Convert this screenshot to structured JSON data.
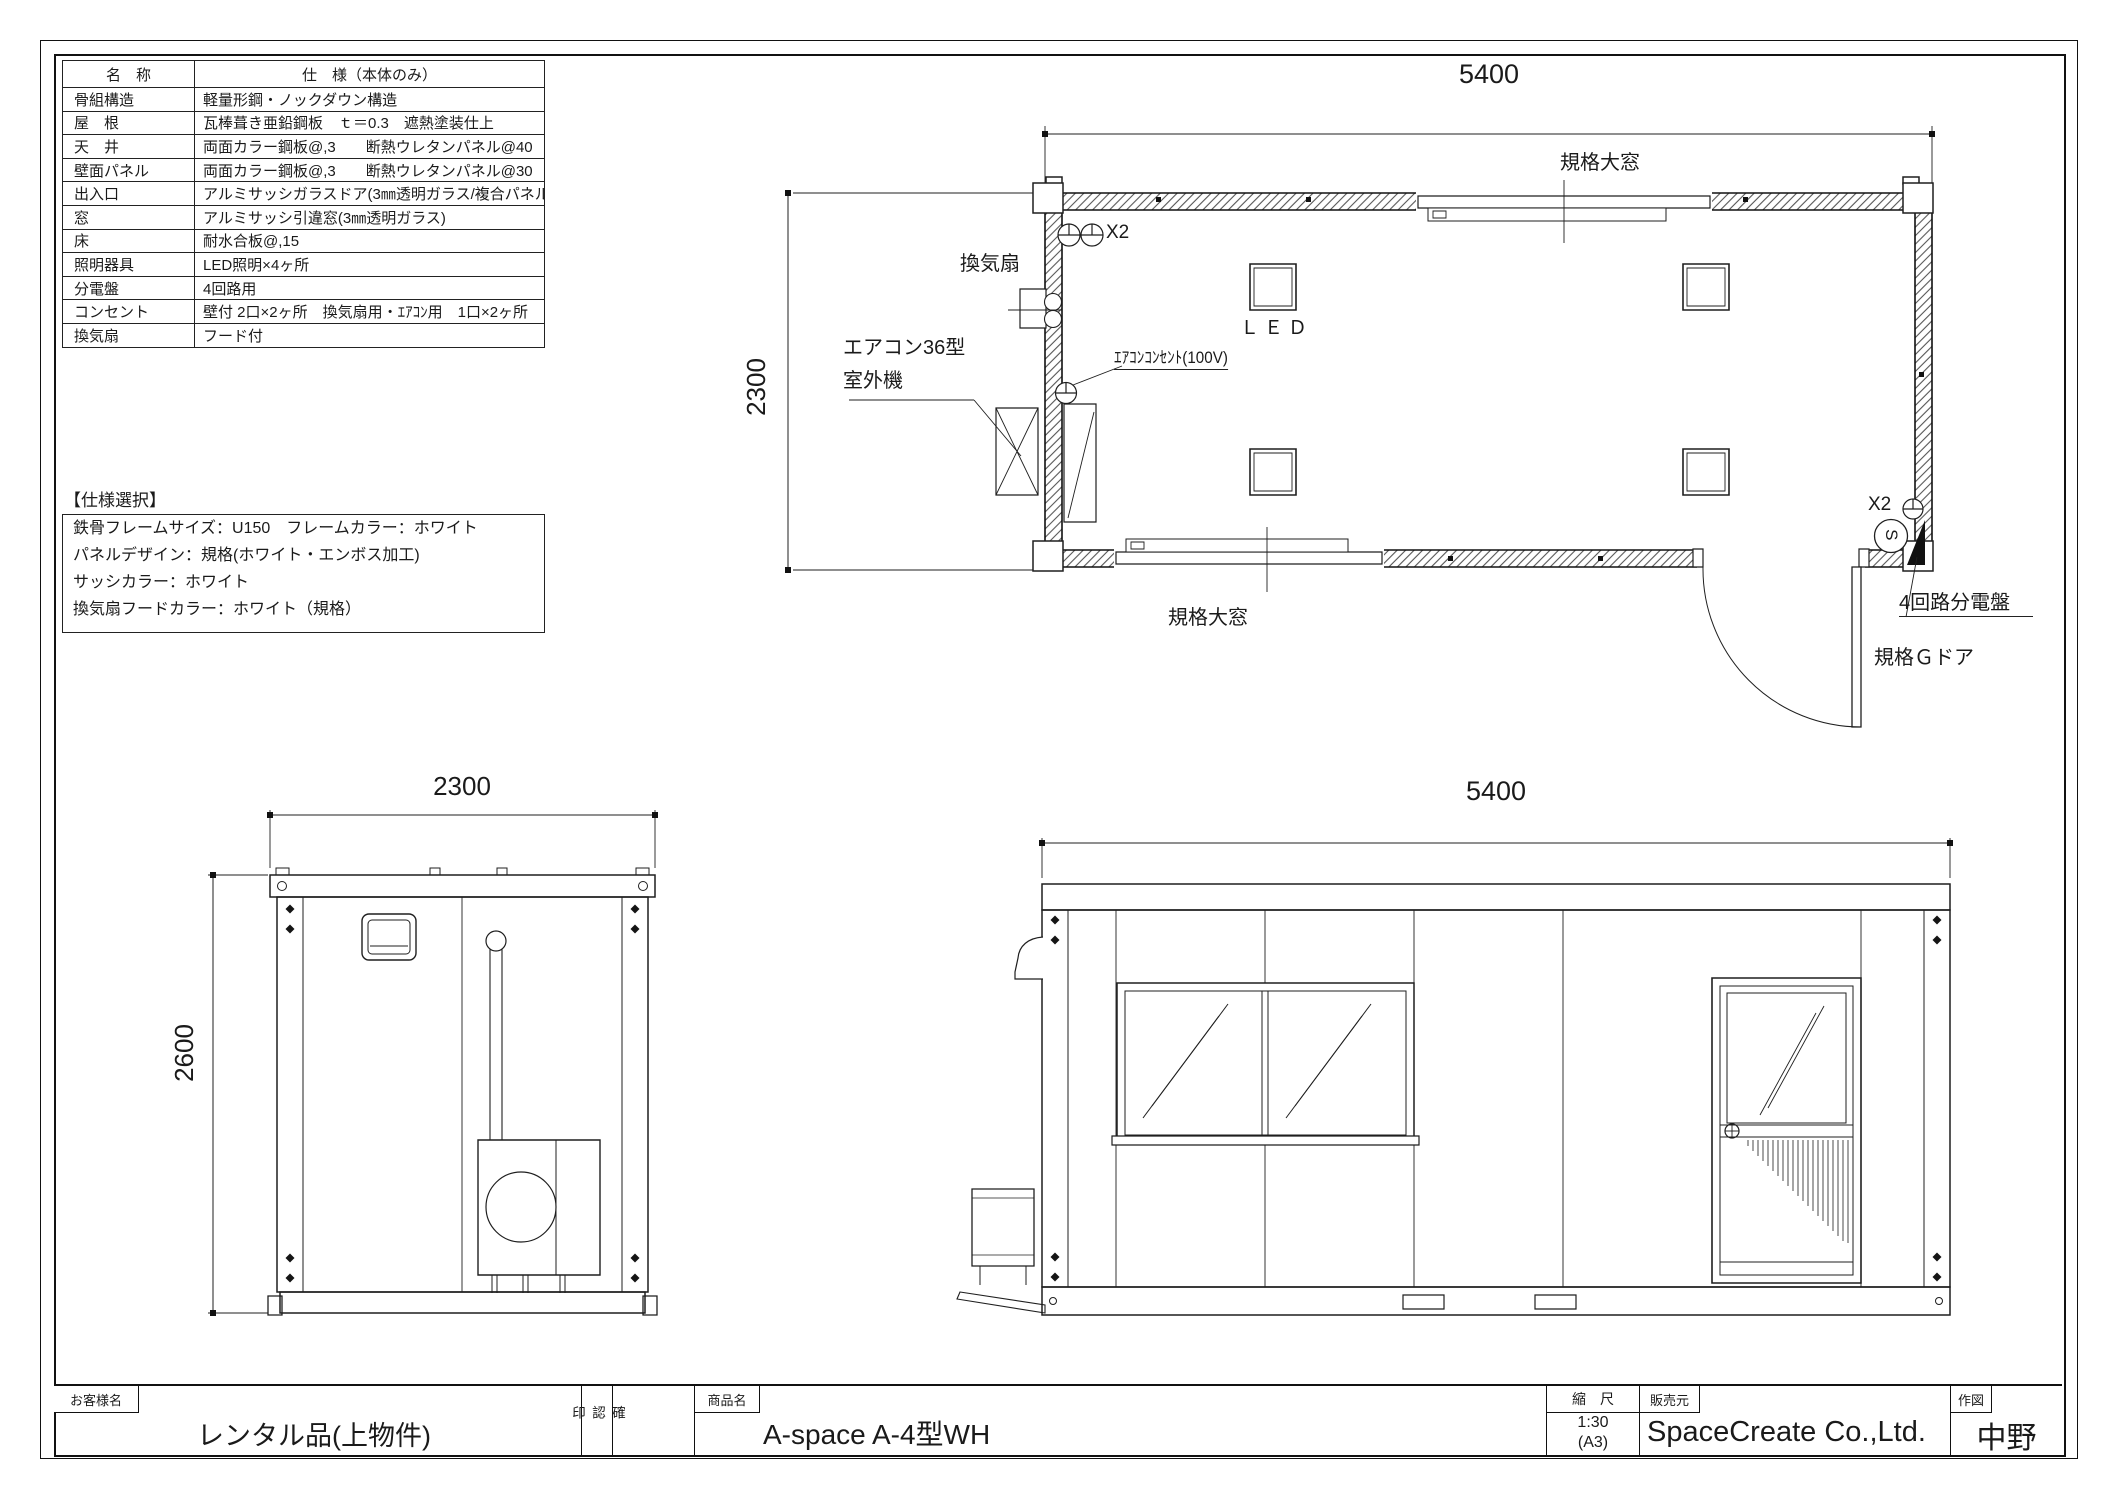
{
  "spec_table": {
    "header": {
      "name": "名　称",
      "spec": "仕　様（本体のみ）"
    },
    "rows": [
      {
        "name": "骨組構造",
        "value": "軽量形鋼・ノックダウン構造"
      },
      {
        "name": "屋　根",
        "value": "瓦棒葺き亜鉛鋼板　ｔ＝0.3　遮熱塗装仕上"
      },
      {
        "name": "天　井",
        "value": "両面カラー鋼板@,3　　断熱ウレタンパネル@40"
      },
      {
        "name": "壁面パネル",
        "value": "両面カラー鋼板@,3　　断熱ウレタンパネル@30"
      },
      {
        "name": "出入口",
        "value": "アルミサッシガラスドア(3㎜透明ガラス/複合パネル)"
      },
      {
        "name": "窓",
        "value": "アルミサッシ引違窓(3㎜透明ガラス)"
      },
      {
        "name": "床",
        "value": "耐水合板@,15"
      },
      {
        "name": "照明器具",
        "value": "LED照明×4ヶ所"
      },
      {
        "name": "分電盤",
        "value": "4回路用"
      },
      {
        "name": "コンセント",
        "value": "壁付 2口×2ヶ所　換気扇用・ｴｱｺﾝ用　1口×2ヶ所"
      },
      {
        "name": "換気扇",
        "value": "フード付"
      }
    ]
  },
  "spec_select": {
    "title": "【仕様選択】",
    "lines": [
      "鉄骨フレームサイズ：U150　フレームカラー：ホワイト",
      "パネルデザイン：規格(ホワイト・エンボス加工)",
      "サッシカラー：ホワイト",
      "換気扇フードカラー：ホワイト（規格）"
    ]
  },
  "floor_plan": {
    "dim_width": "5400",
    "dim_depth": "2300",
    "window_top_label": "規格大窓",
    "window_bottom_label": "規格大窓",
    "vent_fan_label": "換気扇",
    "outdoor_unit_label_line1": "エアコン36型",
    "outdoor_unit_label_line2": "室外機",
    "ac_outlet_label": "ｴｱｺﾝｺﾝｾﾝﾄ(100V)",
    "led_label": "ＬＥＤ",
    "outlet_top_left_label": "X2",
    "outlet_bottom_right_label": "X2",
    "switch_symbol": "S",
    "breaker_label": "4回路分電盤",
    "door_label": "規格Ｇドア"
  },
  "side_elevation": {
    "dim_width": "2300",
    "dim_height": "2600"
  },
  "front_elevation": {
    "dim_width": "5400"
  },
  "title_block": {
    "customer_label": "お客様名",
    "customer_value": "レンタル品(上物件)",
    "approval_label": "確認印",
    "product_label": "商品名",
    "product_value": "A-space A-4型WH",
    "scale_label": "縮　尺",
    "scale_value": "1:30",
    "scale_paper": "(A3)",
    "seller_label": "販売元",
    "seller_value": "SpaceCreate Co.,Ltd.",
    "drawer_label": "作図",
    "drawer_value": "中野"
  }
}
